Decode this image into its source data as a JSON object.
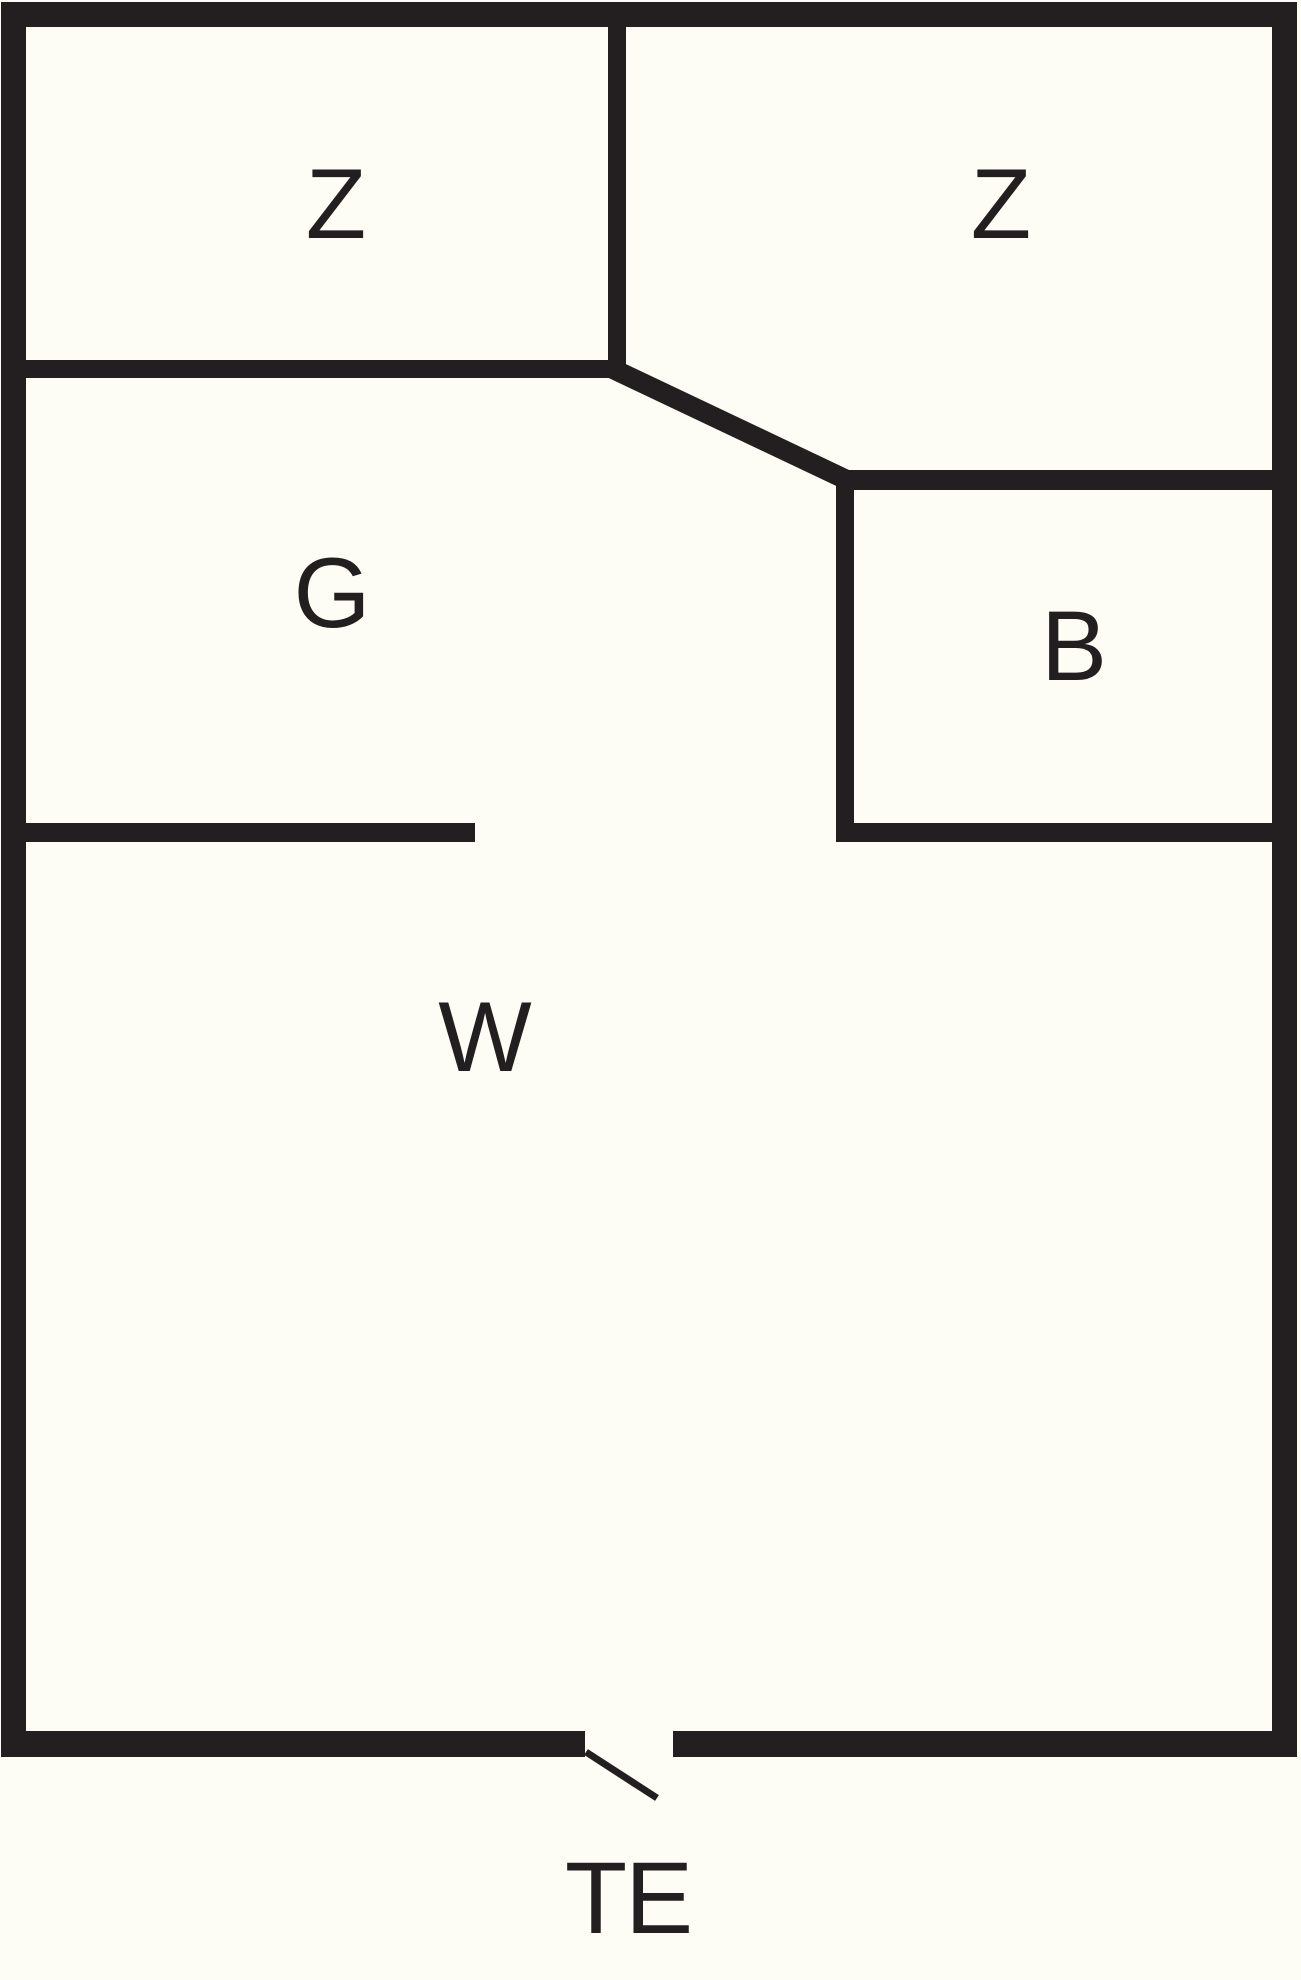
{
  "diagram": {
    "type": "floor-plan",
    "labels": {
      "bedroom_left": "Z",
      "bedroom_right": "Z",
      "hall": "G",
      "bathroom": "B",
      "living_room": "W",
      "entrance": "TE"
    },
    "colors": {
      "wall": "#231f20",
      "background": "#fdfdf5",
      "text": "#231f20"
    }
  }
}
